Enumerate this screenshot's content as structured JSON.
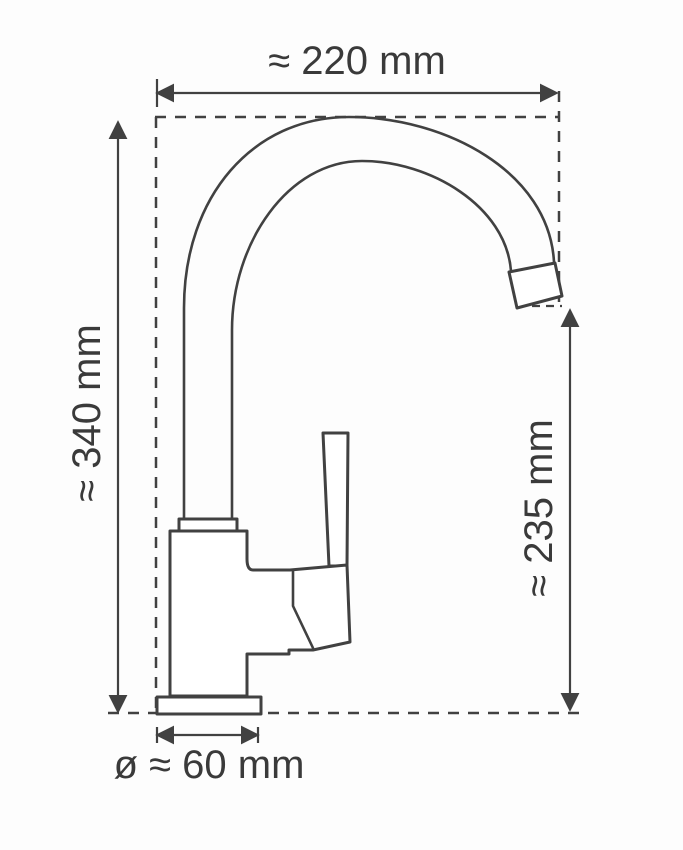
{
  "diagram": {
    "subject": "kitchen-faucet-technical-drawing",
    "labels": {
      "width": "≈ 220 mm",
      "height": "≈ 340 mm",
      "spout_height": "≈ 235 mm",
      "base_diameter": "ø ≈ 60 mm"
    },
    "colors": {
      "line": "#414141",
      "text": "#3a3a3a",
      "background": "#fdfdfd"
    }
  }
}
